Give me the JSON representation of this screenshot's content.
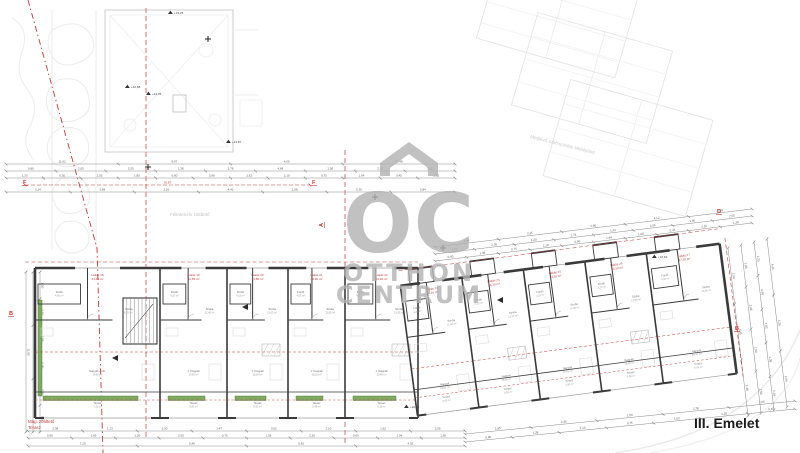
{
  "drawing": {
    "floor_label": "III. Emelet",
    "watermark": {
      "logo_text": "OC",
      "line1": "OTTHON",
      "line2": "CENTRUM"
    },
    "neighbor_label": "Meglévő szomszédos lakóépület",
    "roof_label": "Félintenzív zöldtető",
    "terrace_label_line1": "Mag. zöldtető",
    "terrace_label_line2": "Terasz",
    "colors": {
      "wall": "#3a3a3a",
      "red": "#c43a35",
      "dim": "#8a8a8a",
      "faint": "#e3e3e3",
      "green": "#7fa861",
      "green_dark": "#5d8245",
      "watermark": "#b2b2b2",
      "room_text": "#6f6f6f"
    }
  },
  "levels": [
    {
      "t": "+12,88",
      "x": 125,
      "y": 88
    },
    {
      "t": "+13,05",
      "x": 146,
      "y": 95
    },
    {
      "t": "+13,25",
      "x": 168,
      "y": 14
    },
    {
      "t": "+13,87",
      "x": 226,
      "y": 143
    },
    {
      "t": "+10,63",
      "x": 652,
      "y": 258
    },
    {
      "t": "+10,43",
      "x": 404,
      "y": 408
    }
  ],
  "markers": [
    {
      "t": "F",
      "x": 23,
      "y": 184,
      "r": 0
    },
    {
      "t": "F",
      "x": 312,
      "y": 184,
      "r": 0
    },
    {
      "t": "A",
      "x": 323,
      "y": 227,
      "r": -90
    },
    {
      "t": "D",
      "x": 717,
      "y": 213,
      "r": 0
    },
    {
      "t": "B",
      "x": 9,
      "y": 315,
      "r": 0
    },
    {
      "t": "B",
      "x": 735,
      "y": 330,
      "r": 0
    }
  ],
  "crosses": [
    {
      "x": 148,
      "y": 167
    },
    {
      "x": 375,
      "y": 197
    },
    {
      "x": 443,
      "y": 248
    },
    {
      "x": 208,
      "y": 39
    }
  ],
  "chains": [
    {
      "x1": 6,
      "y1": 164,
      "x2": 455,
      "y2": 164,
      "nums": [
        "11,62",
        "6,07",
        "4,05",
        "15,48"
      ]
    },
    {
      "x1": 6,
      "y1": 171,
      "x2": 455,
      "y2": 171,
      "nums": [
        "0,90",
        "2,05",
        "3,25",
        "1,38",
        "2,78",
        "4,68",
        "1,50",
        "2,36",
        "3,02"
      ]
    },
    {
      "x1": 6,
      "y1": 178,
      "x2": 455,
      "y2": 178,
      "nums": [
        "1,20",
        "0,30",
        "2,55",
        "1,85",
        "0,60",
        "3,99",
        "1,62",
        "2,10",
        "0,75",
        "1,94",
        "0,45",
        "2,62"
      ]
    },
    {
      "x1": 6,
      "y1": 192,
      "x2": 455,
      "y2": 192,
      "nums": [
        "5,24",
        "3,68",
        "2,26",
        "4,41",
        "1,08",
        "3,30",
        "2,84"
      ]
    },
    {
      "x1": 435,
      "y1": 247,
      "x2": 752,
      "y2": 209,
      "nums": [
        "4,68",
        "3,35",
        "2,90",
        "4,12",
        "3,58"
      ]
    },
    {
      "x1": 435,
      "y1": 254,
      "x2": 752,
      "y2": 216,
      "nums": [
        "1,50",
        "2,36",
        "1,20",
        "2,78",
        "1,62",
        "2,05",
        "1,85",
        "2,55"
      ]
    },
    {
      "x1": 435,
      "y1": 261,
      "x2": 752,
      "y2": 223,
      "nums": [
        "0,90",
        "1,38",
        "0,75",
        "2,10",
        "0,60",
        "1,94",
        "1,08",
        "0,45",
        "2,26",
        "1,30"
      ]
    },
    {
      "x1": 28,
      "y1": 431,
      "x2": 465,
      "y2": 431,
      "nums": [
        "2,38",
        "1,13",
        "2,90",
        "1,47",
        "3,02",
        "2,10",
        "1,62",
        "2,55"
      ]
    },
    {
      "x1": 28,
      "y1": 438,
      "x2": 465,
      "y2": 438,
      "nums": [
        "0,90",
        "1,85",
        "1,20",
        "2,05",
        "0,75",
        "1,38",
        "2,26",
        "0,60",
        "1,94",
        "1,50"
      ]
    },
    {
      "x1": 28,
      "y1": 446,
      "x2": 465,
      "y2": 446,
      "nums": [
        "7,23",
        "5,48",
        "6,81",
        "4,92"
      ]
    },
    {
      "x1": 465,
      "y1": 434,
      "x2": 795,
      "y2": 401,
      "nums": [
        "1,85",
        "2,36",
        "1,50",
        "2,78",
        "2,05"
      ]
    },
    {
      "x1": 465,
      "y1": 442,
      "x2": 795,
      "y2": 409,
      "nums": [
        "0,90",
        "1,38",
        "2,10",
        "0,75",
        "1,62",
        "1,20",
        "0,45"
      ]
    },
    {
      "x1": 26,
      "y1": 272,
      "x2": 26,
      "y2": 432,
      "nums": [
        "11,95"
      ]
    },
    {
      "x1": 33,
      "y1": 272,
      "x2": 33,
      "y2": 432,
      "nums": [
        "3,45",
        "2,90",
        "4,12"
      ]
    },
    {
      "x1": 40,
      "y1": 272,
      "x2": 40,
      "y2": 432,
      "nums": [
        "1,50",
        "2,36",
        "1,85",
        "0,90",
        "2,05",
        "1,62"
      ]
    },
    {
      "x1": 728,
      "y1": 248,
      "x2": 748,
      "y2": 416,
      "nums": [
        "2,90",
        "3,45",
        "2,36"
      ]
    },
    {
      "x1": 741,
      "y1": 245,
      "x2": 761,
      "y2": 413,
      "nums": [
        "1,85",
        "2,05",
        "1,50",
        "2,55"
      ]
    },
    {
      "x1": 754,
      "y1": 242,
      "x2": 774,
      "y2": 410,
      "nums": [
        "1,20",
        "0,90",
        "1,62",
        "1,38",
        "2,10"
      ]
    },
    {
      "x1": 767,
      "y1": 239,
      "x2": 787,
      "y2": 407,
      "nums": [
        "4,41",
        "3,30",
        "3,99"
      ]
    }
  ],
  "red_chain": {
    "x1": 25,
    "y1": 185,
    "x2": 310,
    "y2": 185,
    "nums": [
      "30,87"
    ]
  },
  "units_left": [
    {
      "x": 35,
      "w": 125,
      "label": "Lakás 18",
      "area": "61,40 m²",
      "stair": true,
      "rooms": [
        [
          "Fürdő",
          "4,60 m²"
        ],
        [
          "1. Szoba",
          "14,25 m²"
        ],
        [
          "Nappali + étk.",
          "24,80 m²"
        ],
        [
          "Terasz",
          "7,20 m²"
        ]
      ]
    },
    {
      "x": 160,
      "w": 67,
      "label": "Lakás 19",
      "area": "42,65 m²",
      "rooms": [
        [
          "Fürdő",
          "4,20 m²"
        ],
        [
          "Szoba",
          "12,40 m²"
        ],
        [
          "1. Nappali",
          "19,65 m²"
        ],
        [
          "Terasz",
          "5,80 m²"
        ]
      ]
    },
    {
      "x": 227,
      "w": 61,
      "label": "Lakás 20",
      "area": "41,80 m²",
      "shaft": true,
      "rooms": [
        [
          "Fürdő",
          "4,15 m²"
        ],
        [
          "Szoba",
          "12,05 m²"
        ],
        [
          "1. Nappali",
          "18,90 m²"
        ],
        [
          "Terasz",
          "5,60 m²"
        ]
      ]
    },
    {
      "x": 288,
      "w": 57,
      "label": "Lakás 21",
      "area": "40,95 m²",
      "rooms": [
        [
          "Fürdő",
          "4,05 m²"
        ],
        [
          "Szoba",
          "11,80 m²"
        ],
        [
          "1. Nappali",
          "18,20 m²"
        ],
        [
          "Terasz",
          "5,45 m²"
        ]
      ]
    },
    {
      "x": 345,
      "w": 73,
      "label": "Lakás 22",
      "area": "44,20 m²",
      "shaft": true,
      "rooms": [
        [
          "Fürdő",
          "4,30 m²"
        ],
        [
          "Szoba",
          "12,95 m²"
        ],
        [
          "1. Nappali",
          "20,40 m²"
        ],
        [
          "Terasz",
          "6,10 m²"
        ]
      ]
    }
  ],
  "units_right": [
    {
      "x": 418,
      "w": 62,
      "label": "Lakás 23",
      "area": "43,10 m²",
      "rooms": [
        [
          "Fürdő",
          "4,20 m²"
        ],
        [
          "Szoba",
          "12,50 m²"
        ],
        [
          "Nappali",
          "19,80 m²"
        ],
        [
          "Terasz",
          "5,90 m²"
        ]
      ]
    },
    {
      "x": 480,
      "w": 62,
      "label": "Lakás 24",
      "area": "43,10 m²",
      "shaft": true,
      "rooms": [
        [
          "Fürdő",
          "4,20 m²"
        ],
        [
          "Szoba",
          "12,50 m²"
        ],
        [
          "Nappali",
          "19,80 m²"
        ],
        [
          "Terasz",
          "5,90 m²"
        ]
      ]
    },
    {
      "x": 542,
      "w": 62,
      "label": "Lakás 25",
      "area": "43,10 m²",
      "rooms": [
        [
          "Fürdő",
          "4,20 m²"
        ],
        [
          "Szoba",
          "12,50 m²"
        ],
        [
          "Nappali",
          "19,80 m²"
        ],
        [
          "Terasz",
          "5,90 m²"
        ]
      ]
    },
    {
      "x": 604,
      "w": 62,
      "label": "Lakás 26",
      "area": "43,10 m²",
      "shaft": true,
      "rooms": [
        [
          "Fürdő",
          "4,20 m²"
        ],
        [
          "Szoba",
          "12,50 m²"
        ],
        [
          "Nappali",
          "19,80 m²"
        ],
        [
          "Terasz",
          "5,90 m²"
        ]
      ]
    },
    {
      "x": 666,
      "w": 74,
      "label": "Lakás 27",
      "area": "47,35 m²",
      "rooms": [
        [
          "Fürdő",
          "4,55 m²"
        ],
        [
          "Szoba",
          "13,60 m²"
        ],
        [
          "Nappali",
          "21,70 m²"
        ],
        [
          "Terasz",
          "6,45 m²"
        ]
      ]
    }
  ]
}
